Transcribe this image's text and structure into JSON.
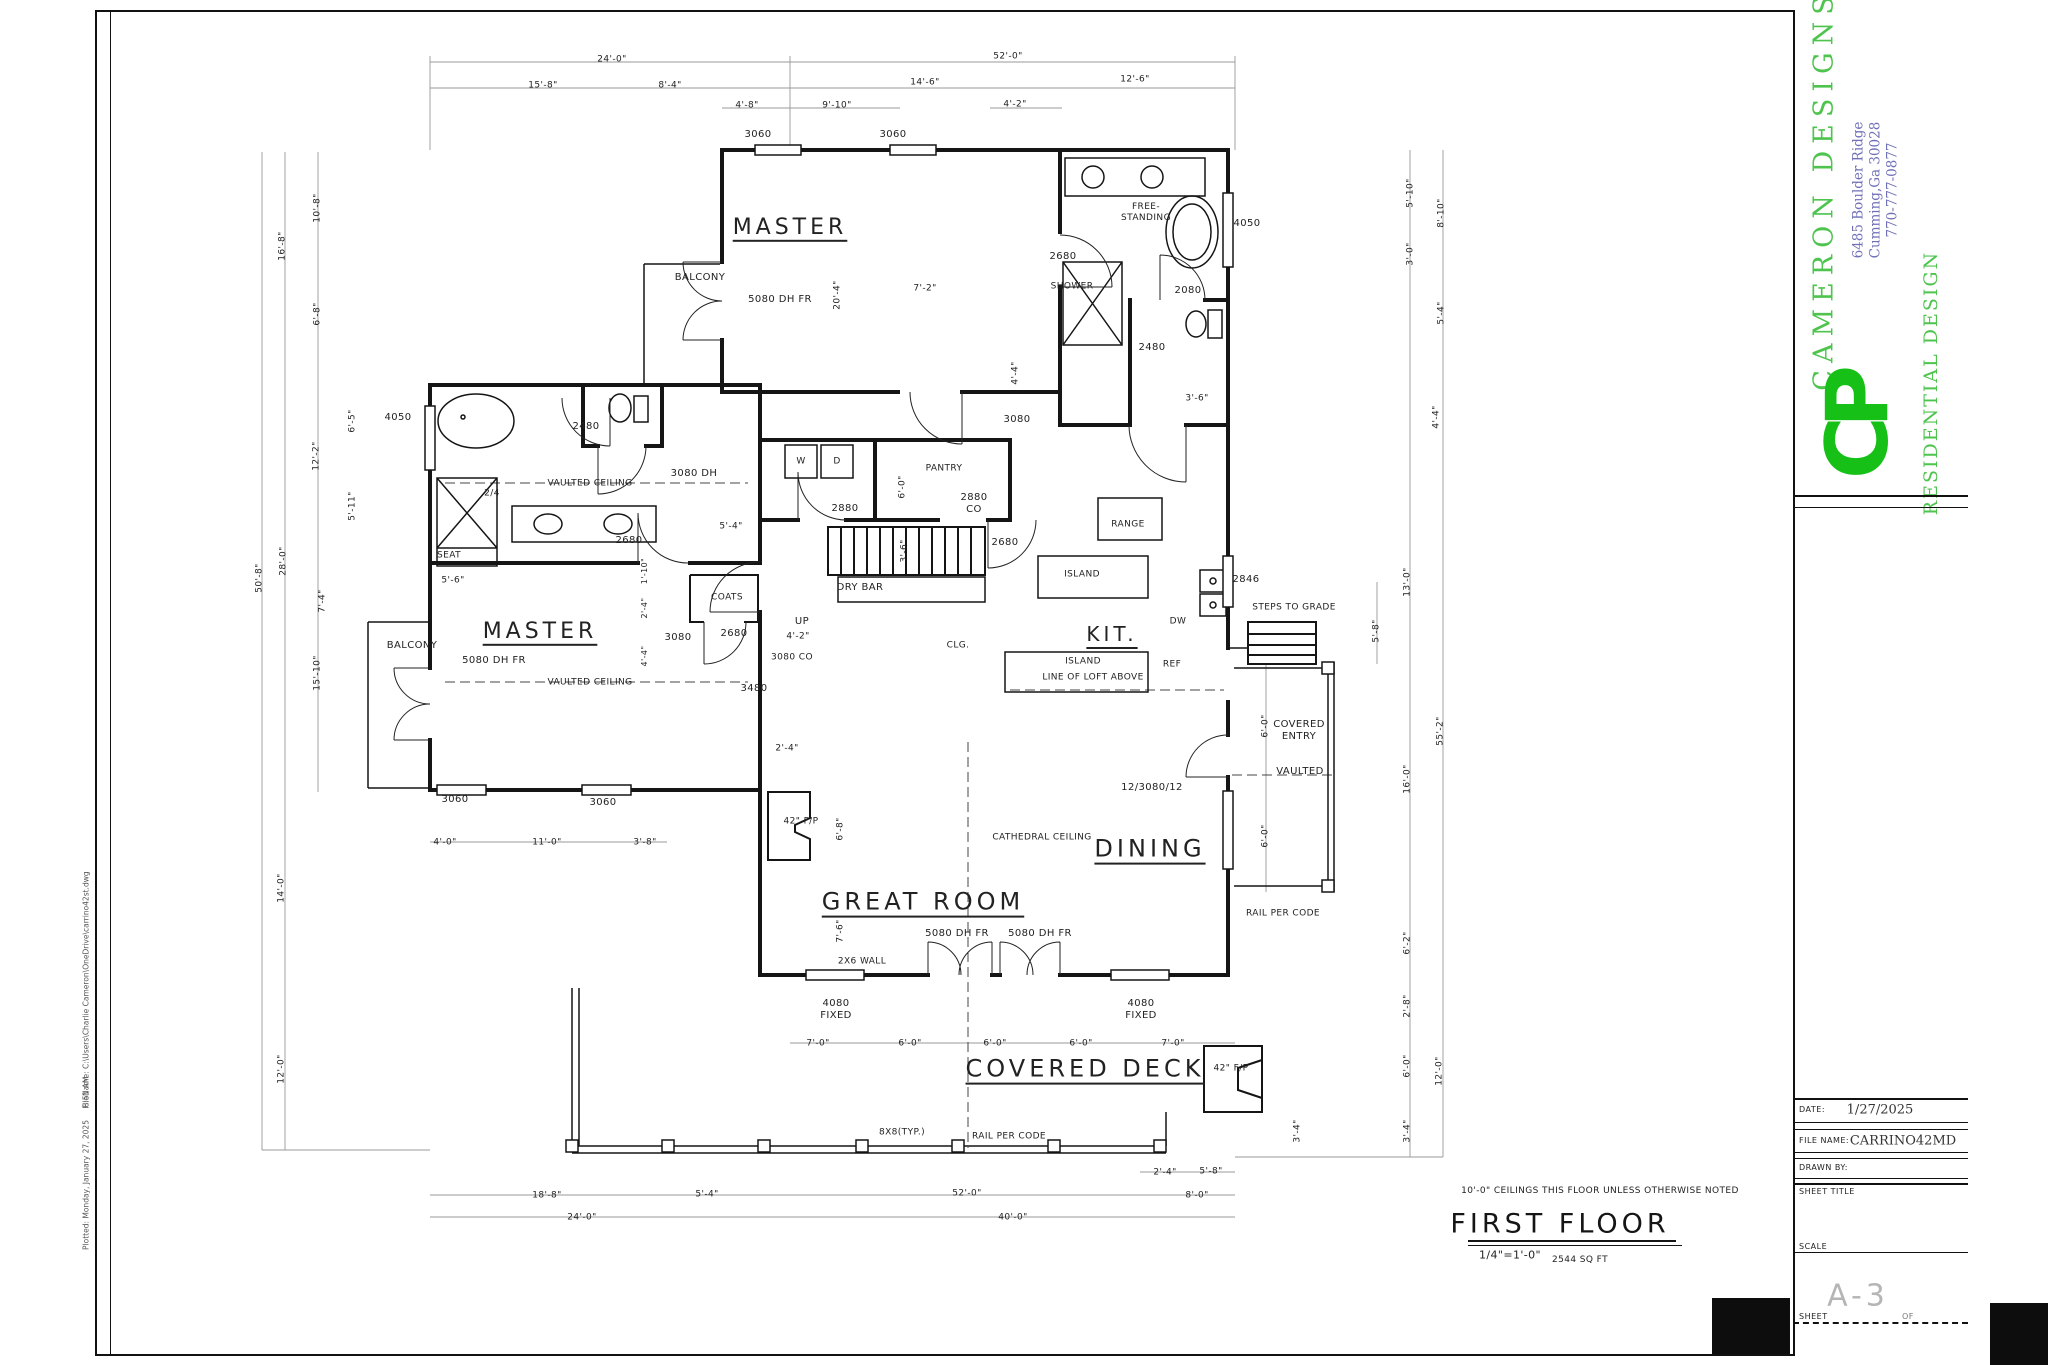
{
  "colors": {
    "green": "#4ec44e",
    "logo_green": "#16c016",
    "blue": "#7070b8",
    "line": "#1a1a1a",
    "dim_gray": "#999999",
    "sheet_number_gray": "#b5b5b5"
  },
  "edge": {
    "filename": "FileName: C:\\Users\\Charlie Cameron\\OneDrive\\carrino42st.dwg",
    "time": "8:51 AM",
    "plotted": "Plotted: Monday, January 27, 2025"
  },
  "title_block": {
    "company": "CAMERON DESIGNS",
    "address": "6485 Boulder Ridge\nCumming,Ga 30028\n770-777-0877",
    "tagline": "RESIDENTIAL DESIGN",
    "logo": "CP",
    "date_label": "DATE:",
    "date_value": "1/27/2025",
    "file_label": "FILE NAME:",
    "file_value": "CARRINO42MD",
    "drawn_label": "DRAWN BY:",
    "sheet_title_label": "SHEET TITLE",
    "scale_label": "SCALE",
    "sheet_label": "SHEET",
    "sheet_number": "A-3",
    "of_label": "OF"
  },
  "plan_title": {
    "note": "10'-0\" CEILINGS THIS FLOOR UNLESS OTHERWISE NOTED",
    "name": "FIRST FLOOR",
    "scale": "1/4\"=1'-0\"",
    "area": "2544 SQ FT"
  },
  "plan": {
    "labels": [
      [
        "24'-0\"",
        612,
        60,
        9
      ],
      [
        "52'-0\"",
        1008,
        57,
        9
      ],
      [
        "15'-8\"",
        543,
        86,
        9
      ],
      [
        "8'-4\"",
        670,
        86,
        9
      ],
      [
        "14'-6\"",
        925,
        83,
        9
      ],
      [
        "12'-6\"",
        1135,
        80,
        9
      ],
      [
        "4'-8\"",
        747,
        106,
        9
      ],
      [
        "9'-10\"",
        837,
        106,
        9
      ],
      [
        "4'-2\"",
        1015,
        105,
        9
      ],
      [
        "3060",
        758,
        135,
        10
      ],
      [
        "3060",
        893,
        135,
        10
      ],
      [
        "MASTER",
        790,
        228,
        22,
        0,
        "room"
      ],
      [
        "BALCONY",
        700,
        278,
        10
      ],
      [
        "5080 DH FR",
        780,
        300,
        10
      ],
      [
        "20'-4\"",
        838,
        295,
        9,
        1
      ],
      [
        "7'-2\"",
        925,
        289,
        9
      ],
      [
        "FREE-\nSTANDING",
        1146,
        213,
        9
      ],
      [
        "4050",
        1247,
        224,
        10
      ],
      [
        "2680",
        1063,
        257,
        10
      ],
      [
        "SHOWER",
        1072,
        287,
        9
      ],
      [
        "2080",
        1188,
        291,
        10
      ],
      [
        "2480",
        1152,
        348,
        10
      ],
      [
        "3'-6\"",
        1197,
        399,
        9
      ],
      [
        "4'-4\"",
        1016,
        373,
        9,
        1
      ],
      [
        "3080",
        1017,
        420,
        10
      ],
      [
        "5'-10\"",
        1411,
        193,
        9,
        1
      ],
      [
        "8'-10\"",
        1442,
        213,
        9,
        1
      ],
      [
        "3'-0\"",
        1411,
        254,
        9,
        1
      ],
      [
        "5'-4\"",
        1442,
        313,
        9,
        1
      ],
      [
        "4'-4\"",
        1437,
        417,
        9,
        1
      ],
      [
        "10'-8\"",
        318,
        208,
        9,
        1
      ],
      [
        "16'-8\"",
        283,
        246,
        9,
        1
      ],
      [
        "6'-8\"",
        318,
        314,
        9,
        1
      ],
      [
        "4050",
        398,
        418,
        10
      ],
      [
        "6'-5\"",
        353,
        421,
        9,
        1
      ],
      [
        "2480",
        586,
        427,
        10
      ],
      [
        "12'-2\"",
        317,
        456,
        9,
        1
      ],
      [
        "5'-11\"",
        353,
        506,
        9,
        1
      ],
      [
        "2/4",
        492,
        494,
        9
      ],
      [
        "VAULTED CEILING",
        590,
        484,
        9
      ],
      [
        "3080 DH",
        694,
        474,
        10
      ],
      [
        "28'-0\"",
        284,
        561,
        9,
        1
      ],
      [
        "50'-8\"",
        260,
        578,
        9,
        1
      ],
      [
        "SEAT",
        449,
        556,
        9
      ],
      [
        "2680",
        629,
        541,
        10
      ],
      [
        "5'-4\"",
        731,
        527,
        9
      ],
      [
        "1'-10\"",
        645,
        571,
        8,
        1
      ],
      [
        "5'-6\"",
        453,
        581,
        9
      ],
      [
        "COATS",
        727,
        598,
        9
      ],
      [
        "2'-4\"",
        645,
        608,
        8,
        1
      ],
      [
        "7'-4\"",
        323,
        601,
        9,
        1
      ],
      [
        "MASTER",
        540,
        632,
        22,
        0,
        "room"
      ],
      [
        "3080",
        678,
        638,
        10
      ],
      [
        "2680",
        734,
        634,
        10
      ],
      [
        "4'-4\"",
        645,
        656,
        8,
        1
      ],
      [
        "BALCONY",
        412,
        646,
        10
      ],
      [
        "5080 DH FR",
        494,
        661,
        10
      ],
      [
        "15'-10\"",
        318,
        673,
        9,
        1
      ],
      [
        "VAULTED CEILING",
        590,
        683,
        9
      ],
      [
        "3480",
        754,
        689,
        10
      ],
      [
        "3060",
        455,
        800,
        10
      ],
      [
        "3060",
        603,
        803,
        10
      ],
      [
        "4'-0\"",
        445,
        843,
        9
      ],
      [
        "11'-0\"",
        547,
        843,
        9
      ],
      [
        "3'-8\"",
        645,
        843,
        9
      ],
      [
        "14'-0\"",
        282,
        888,
        9,
        1
      ],
      [
        "12'-0\"",
        282,
        1069,
        9,
        1
      ],
      [
        "18'-8\"",
        547,
        1196,
        9
      ],
      [
        "5'-4\"",
        707,
        1195,
        9
      ],
      [
        "24'-0\"",
        582,
        1218,
        9
      ],
      [
        "W",
        801,
        462,
        9
      ],
      [
        "D",
        837,
        462,
        9
      ],
      [
        "PANTRY",
        944,
        469,
        9
      ],
      [
        "6'-0\"",
        903,
        487,
        9,
        1
      ],
      [
        "2880",
        845,
        509,
        10
      ],
      [
        "2880\nCO",
        974,
        504,
        10
      ],
      [
        "RANGE",
        1128,
        525,
        9
      ],
      [
        "2680",
        1005,
        543,
        10
      ],
      [
        "ISLAND",
        1082,
        575,
        9
      ],
      [
        "2846",
        1246,
        580,
        10
      ],
      [
        "3'-6\"",
        905,
        551,
        9,
        1
      ],
      [
        "DRY BAR",
        860,
        588,
        10
      ],
      [
        "UP",
        802,
        622,
        10
      ],
      [
        "4'-2\"",
        798,
        637,
        9
      ],
      [
        "3080 CO",
        792,
        658,
        9
      ],
      [
        "CLG.",
        958,
        646,
        9
      ],
      [
        "KIT.",
        1112,
        634,
        20,
        0,
        "room"
      ],
      [
        "DW",
        1178,
        622,
        9
      ],
      [
        "REF",
        1172,
        665,
        9
      ],
      [
        "ISLAND",
        1083,
        662,
        9
      ],
      [
        "LINE OF LOFT ABOVE",
        1093,
        678,
        9
      ],
      [
        "STEPS TO GRADE",
        1294,
        608,
        9
      ],
      [
        "13'-0\"",
        1408,
        582,
        9,
        1
      ],
      [
        "5'-8\"",
        1377,
        631,
        9,
        1
      ],
      [
        "COVERED\nENTRY",
        1299,
        731,
        10
      ],
      [
        "VAULTED",
        1300,
        772,
        10
      ],
      [
        "6'-0\"",
        1266,
        726,
        9,
        1
      ],
      [
        "6'-0\"",
        1266,
        836,
        9,
        1
      ],
      [
        "16'-0\"",
        1408,
        779,
        9,
        1
      ],
      [
        "55'-2\"",
        1441,
        731,
        9,
        1
      ],
      [
        "RAIL PER CODE",
        1283,
        914,
        9
      ],
      [
        "6'-2\"",
        1408,
        943,
        9,
        1
      ],
      [
        "12/3080/12",
        1152,
        788,
        10
      ],
      [
        "DINING",
        1150,
        849,
        24,
        0,
        "room"
      ],
      [
        "CATHEDRAL CEILING",
        1042,
        838,
        9
      ],
      [
        "GREAT ROOM",
        923,
        902,
        24,
        0,
        "room"
      ],
      [
        "42\" F/P",
        801,
        822,
        9
      ],
      [
        "6'-8\"",
        841,
        829,
        9,
        1
      ],
      [
        "7'-6\"",
        841,
        931,
        9,
        1
      ],
      [
        "2'-4\"",
        787,
        749,
        9
      ],
      [
        "5080 DH FR",
        957,
        934,
        10
      ],
      [
        "5080 DH FR",
        1040,
        934,
        10
      ],
      [
        "2X6 WALL",
        862,
        962,
        9
      ],
      [
        "4080\nFIXED",
        836,
        1010,
        10
      ],
      [
        "4080\nFIXED",
        1141,
        1010,
        10
      ],
      [
        "7'-0\"",
        818,
        1044,
        9
      ],
      [
        "6'-0\"",
        910,
        1044,
        9
      ],
      [
        "6'-0\"",
        995,
        1044,
        9
      ],
      [
        "6'-0\"",
        1081,
        1044,
        9
      ],
      [
        "7'-0\"",
        1173,
        1044,
        9
      ],
      [
        "COVERED DECK",
        1085,
        1069,
        24,
        0,
        "room"
      ],
      [
        "42\" F/P",
        1231,
        1069,
        9
      ],
      [
        "8X8(TYP.)",
        902,
        1133,
        9
      ],
      [
        "RAIL PER CODE",
        1009,
        1137,
        9
      ],
      [
        "3'-4\"",
        1298,
        1131,
        9,
        1
      ],
      [
        "2'-4\"",
        1165,
        1173,
        9
      ],
      [
        "5'-8\"",
        1211,
        1172,
        9
      ],
      [
        "52'-0\"",
        967,
        1194,
        9
      ],
      [
        "8'-0\"",
        1197,
        1196,
        9
      ],
      [
        "40'-0\"",
        1013,
        1218,
        9
      ],
      [
        "2'-8\"",
        1408,
        1006,
        9,
        1
      ],
      [
        "6'-0\"",
        1408,
        1066,
        9,
        1
      ],
      [
        "12'-0\"",
        1440,
        1071,
        9,
        1
      ],
      [
        "3'-4\"",
        1408,
        1131,
        9,
        1
      ]
    ]
  }
}
